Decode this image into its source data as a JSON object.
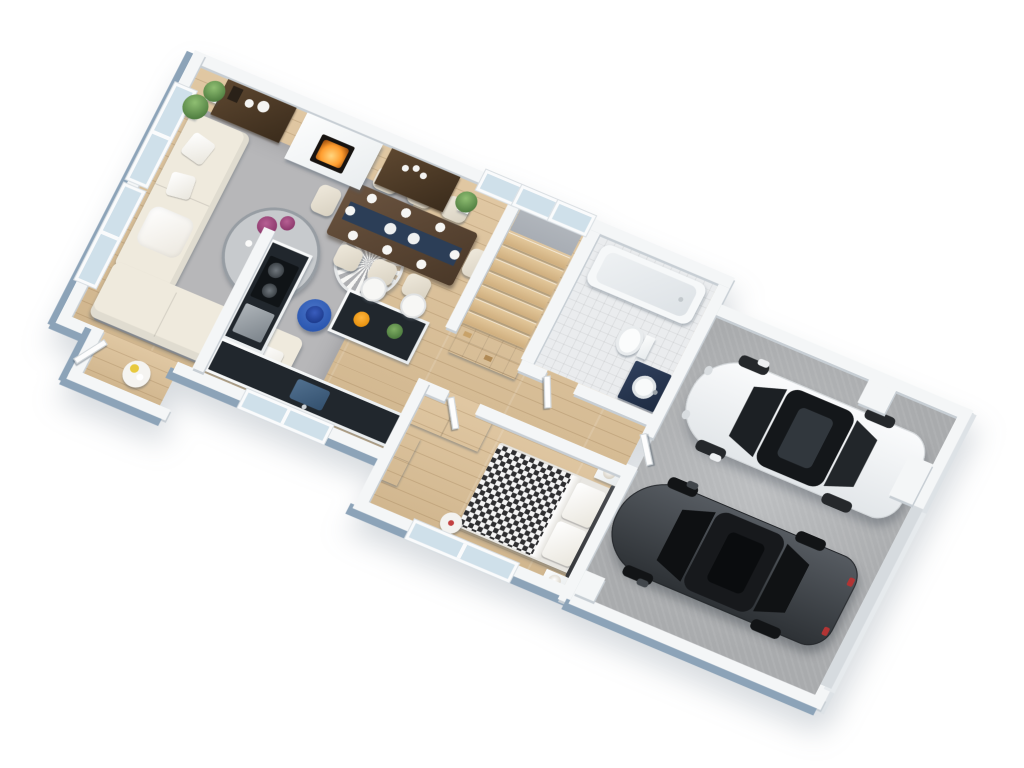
{
  "scene": {
    "type": "3d-floor-plan-render",
    "description": "Isometric top-down 3D rendering of a single-storey home interior with attached two-car garage, no visible text",
    "background": "#ffffff",
    "view_rotation_deg": 23
  },
  "palette": {
    "bg": "#ffffff",
    "wood": "#dcc096",
    "tile": "#eaecee",
    "concrete": "#b3b5b7",
    "wallTop": "#f4f6f7",
    "wallExt": "#8ca3b8",
    "wallInt": "#c7ced4",
    "rug": "#b7b7b9",
    "sofa": "#efeadd",
    "darkwood": "#4e3b28",
    "counter": "#21272d",
    "navy": "#2c3e57",
    "fire": "#ff9d2e",
    "plant": "#5e8f4f",
    "flower": "#8e3b6e",
    "bluetable": "#2b57b0",
    "carwhite": "#f2f4f5",
    "cardark": "#3c4146",
    "glass": "#cfe0ea",
    "landing": "#a8adb4",
    "check": "#2e2e30",
    "fruit": "#e8920f"
  },
  "rooms": [
    {
      "id": "living-room",
      "floor": "wood",
      "items": [
        "l-shaped cream sectional sofa with pillows and throw",
        "gray area rug",
        "round glass coffee table with purple flowers, candles and tray",
        "round striped lounge chair",
        "royal-blue side table with navy lamp",
        "corner floor plant"
      ]
    },
    {
      "id": "fireplace-wall",
      "items": [
        "white fireplace with burning firebox",
        "dark brown sideboard with white vases (left)",
        "dark brown sideboard with white candles (right)",
        "two potted plants",
        "three windows"
      ]
    },
    {
      "id": "dining-room",
      "items": [
        "dark wood dining table",
        "navy table runner",
        "8 cream chairs",
        "8 white place settings"
      ]
    },
    {
      "id": "kitchen",
      "items": [
        "L-shaped white cabinets with black countertop",
        "cooktop with two pans",
        "oven",
        "navy sink below window",
        "kitchen island with black top",
        "bowl of oranges",
        "small plant",
        "2 white bar stools"
      ]
    },
    {
      "id": "entry-nook",
      "items": [
        "open white entry door",
        "round console table with yellow and white plates"
      ]
    },
    {
      "id": "staircase",
      "items": [
        "7 wooden treads",
        "gray upper landing",
        "white open shelving unit"
      ]
    },
    {
      "id": "bathroom",
      "floor": "tile",
      "items": [
        "white bathtub",
        "toilet",
        "navy vanity with round white sink",
        "open door"
      ]
    },
    {
      "id": "bedroom",
      "floor": "wood",
      "items": [
        "double bed with black-white checkered duvet",
        "two white pillows",
        "dark headboard",
        "2 nightstands with round lamps",
        "white wardrobe",
        "white dresser",
        "round pouf with red accent",
        "window"
      ]
    },
    {
      "id": "garage",
      "floor": "concrete",
      "items": [
        "white sedan",
        "dark gray sedan",
        "garage door opening",
        "wall pillars"
      ]
    }
  ],
  "vehicles": [
    {
      "name": "white-sedan",
      "color": "#f2f4f5",
      "features": [
        "black glass roof",
        "sunroof",
        "side mirrors",
        "4 wheels"
      ]
    },
    {
      "name": "dark-gray-sedan",
      "color": "#3c4146",
      "features": [
        "sunroof",
        "red taillights",
        "side mirrors",
        "4 wheels"
      ]
    }
  ],
  "counts": {
    "dining_chairs": 8,
    "bar_stools": 2,
    "stair_treads": 7,
    "cars": 2,
    "left_wall_windows": 2,
    "top_wall_windows": 3
  }
}
